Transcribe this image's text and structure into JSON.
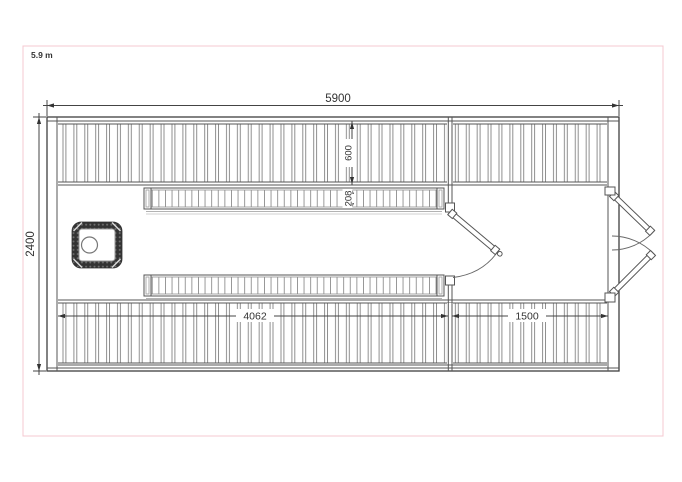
{
  "annotation": {
    "scale_label": "5.9 m"
  },
  "floorplan": {
    "dims": {
      "overall_width": "5900",
      "overall_depth": "2400",
      "deck_depth": "600",
      "bench_depth": "208",
      "sauna_room_length": "4062",
      "terrace_length": "1500"
    },
    "colors": {
      "annotation_red": "#e23b3b",
      "frame_pink": "#f4c8d0",
      "outline_gray": "#3f3f3f",
      "slat_gray": "#8f8f8f",
      "heater_dark": "#333333"
    }
  }
}
